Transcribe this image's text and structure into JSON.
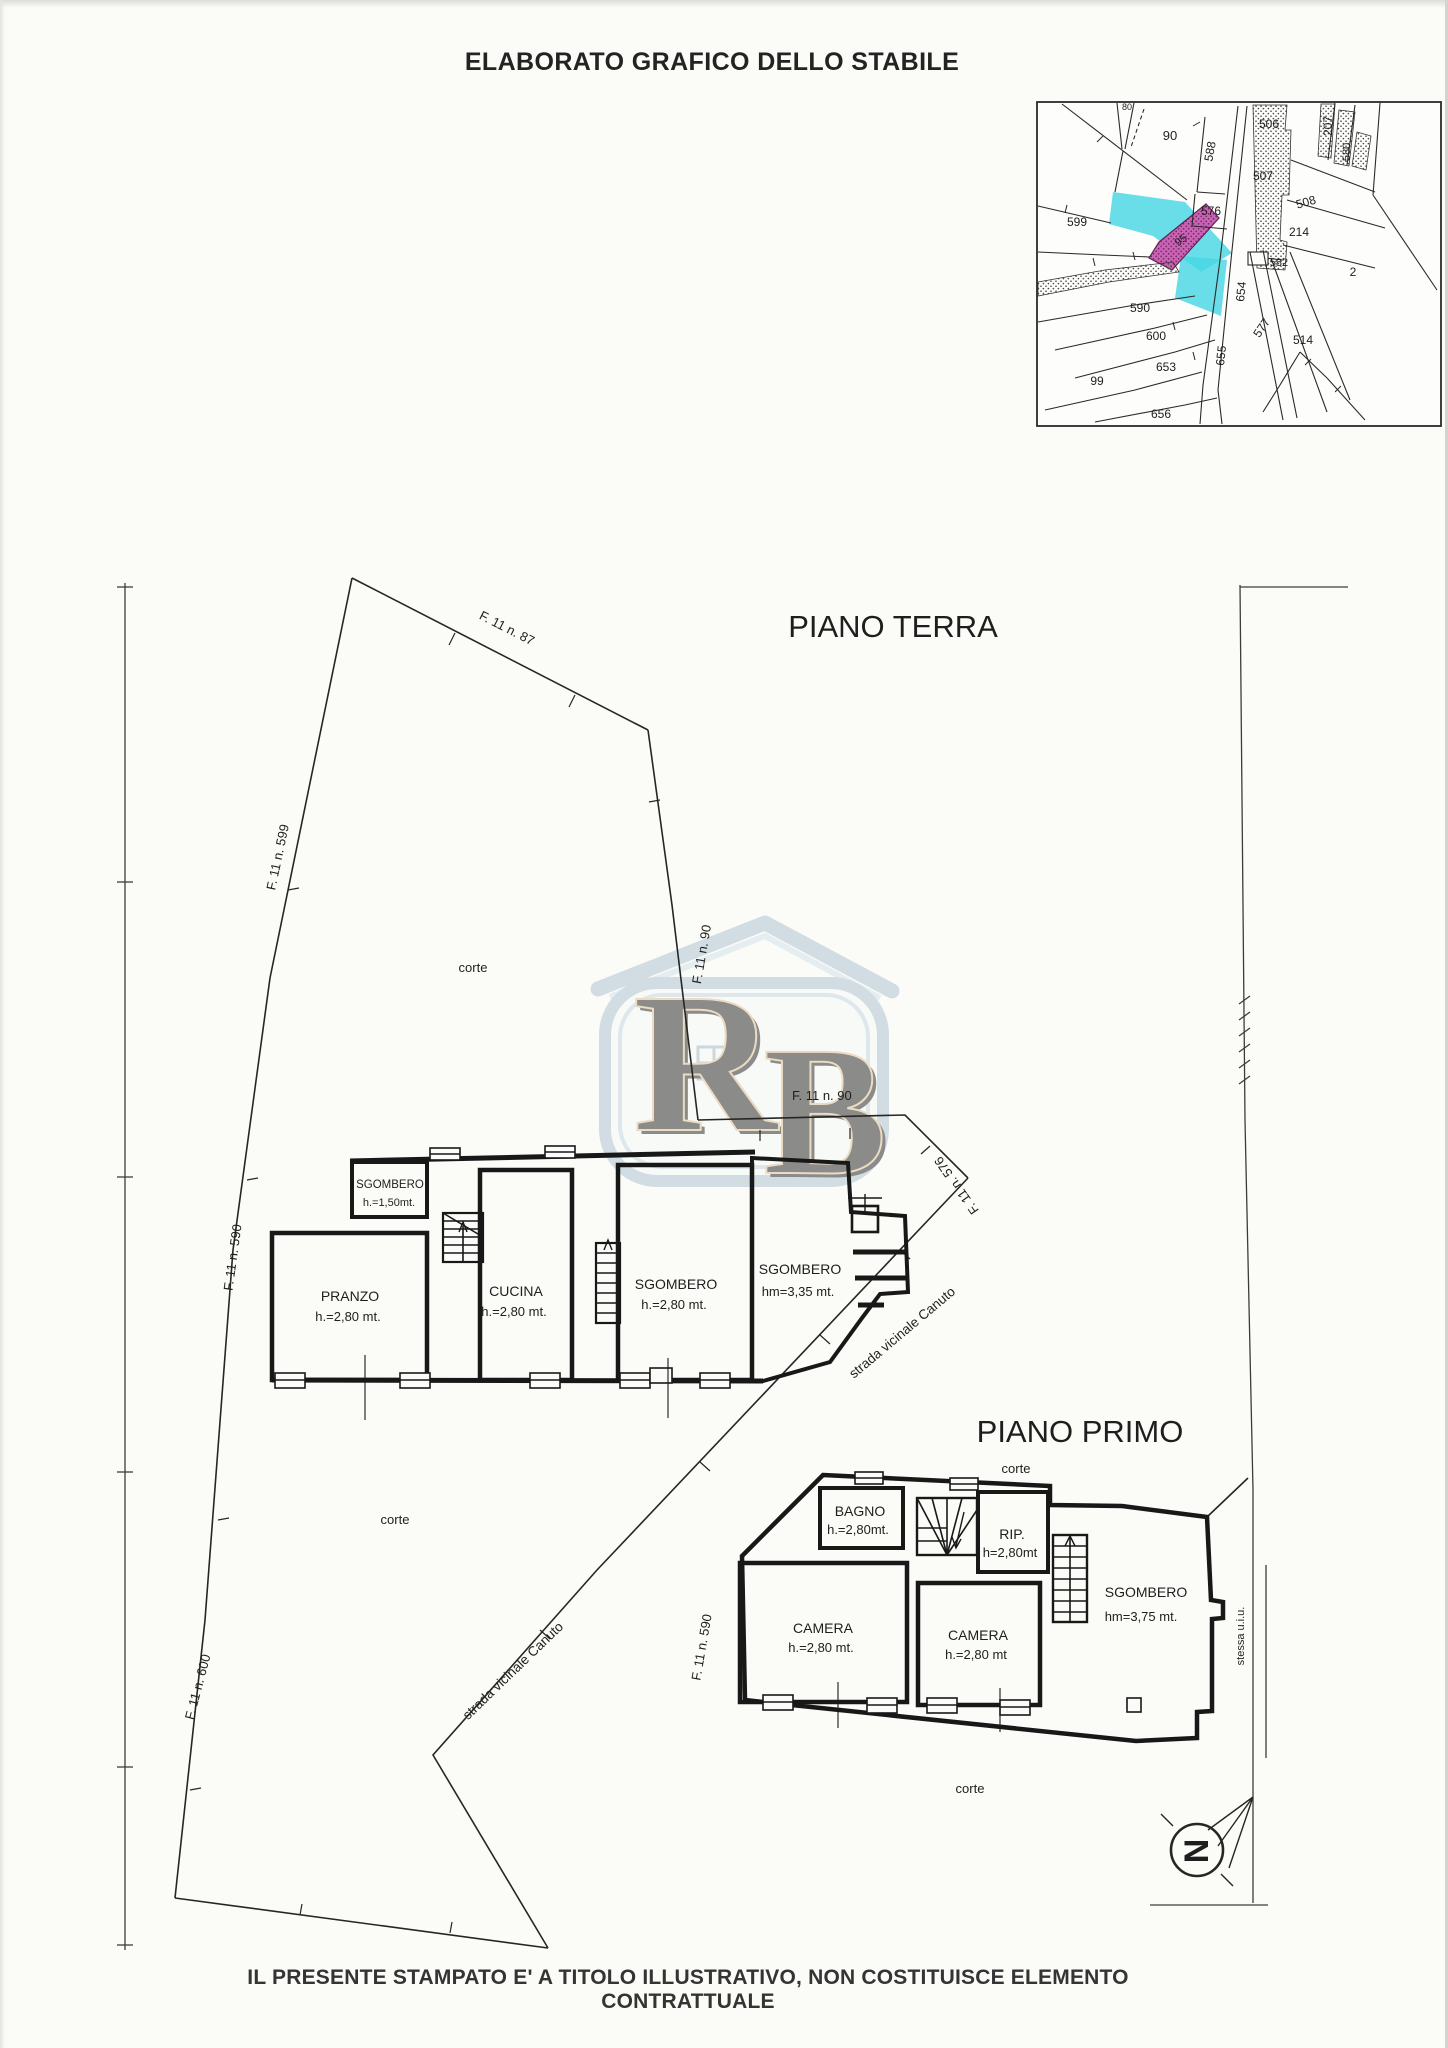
{
  "document": {
    "title": "ELABORATO GRAFICO DELLO STABILE",
    "disclaimer": "IL PRESENTE STAMPATO E' A TITOLO ILLUSTRATIVO, NON COSTITUISCE ELEMENTO CONTRATTUALE"
  },
  "logo": {
    "letter_r": "R",
    "letter_b": "B"
  },
  "inset_map": {
    "highlight_cyan": "#45d6e3",
    "highlight_magenta": "#cb63b5",
    "parcels": {
      "n80": "80",
      "n90": "90",
      "n588": "588",
      "n576": "576",
      "n506": "506",
      "n507": "507",
      "n508": "508",
      "n207": "207",
      "n580": "580",
      "n214": "214",
      "n599": "599",
      "n95": "95",
      "n582": "582",
      "n654": "654",
      "n577": "577",
      "n2": "2",
      "n590": "590",
      "n600": "600",
      "n653": "653",
      "n99": "99",
      "n655": "655",
      "n656": "656",
      "n514": "514"
    }
  },
  "site_plan": {
    "floor_titles": {
      "ground": "PIANO TERRA",
      "first": "PIANO PRIMO"
    },
    "labels": {
      "f87": "F. 11 n. 87",
      "f599": "F. 11 n. 599",
      "f90": "F. 11 n. 90",
      "f590": "F. 11 n. 590",
      "f600": "F. 11 n. 600",
      "f576": "F. 11 n. 576",
      "corte": "corte",
      "strada": "strada vicinale Canuto",
      "stessa": "stessa u.i.u.",
      "north": "N"
    },
    "ground_rooms": {
      "sgombero_small": {
        "name": "SGOMBERO",
        "height": "h.=1,50mt."
      },
      "pranzo": {
        "name": "PRANZO",
        "height": "h.=2,80 mt."
      },
      "cucina": {
        "name": "CUCINA",
        "height": "h.=2,80 mt."
      },
      "sgombero_mid": {
        "name": "SGOMBERO",
        "height": "h.=2,80 mt."
      },
      "sgombero_tall": {
        "name": "SGOMBERO",
        "height": "hm=3,35 mt."
      }
    },
    "first_rooms": {
      "bagno": {
        "name": "BAGNO",
        "height": "h.=2,80mt."
      },
      "rip": {
        "name": "RIP.",
        "height": "h=2,80mt"
      },
      "camera_left": {
        "name": "CAMERA",
        "height": "h.=2,80 mt."
      },
      "camera_right": {
        "name": "CAMERA",
        "height": "h.=2,80 mt"
      },
      "sgombero": {
        "name": "SGOMBERO",
        "height": "hm=3,75 mt."
      }
    }
  }
}
